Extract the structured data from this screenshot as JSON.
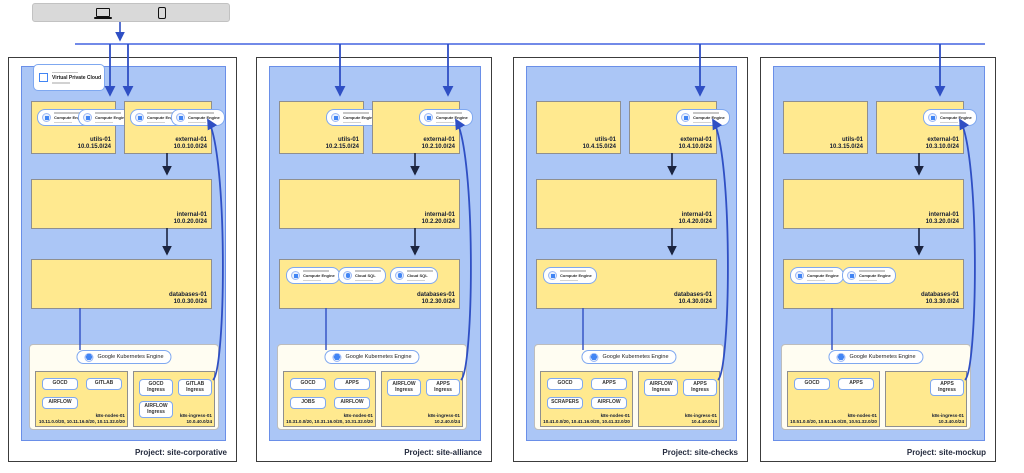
{
  "device_bar": {
    "icons": [
      "laptop",
      "smartphone"
    ]
  },
  "shared": {
    "vpc_label": "Virtual Private Cloud",
    "gke_label": "Google Kubernetes Engine",
    "compute_engine_label": "Compute Engine",
    "cloud_sql_label": "Cloud SQL"
  },
  "colors": {
    "vpc_fill": "#abc6f6",
    "subnet_fill": "#ffe98f",
    "arrow_blue": "#3d5ed2",
    "arrow_dark": "#1b2440"
  },
  "projects": [
    {
      "label": "Project: site-corporative",
      "subnets": {
        "utils": {
          "name": "utils-01",
          "cidr": "10.0.15.0/24",
          "chips": [
            "Compute Engine",
            "Compute Engine"
          ]
        },
        "external": {
          "name": "external-01",
          "cidr": "10.0.10.0/24",
          "chips": [
            "Compute Engine",
            "Compute Engine"
          ]
        },
        "internal": {
          "name": "internal-01",
          "cidr": "10.0.20.0/24",
          "chips": []
        },
        "databases": {
          "name": "databases-01",
          "cidr": "10.0.30.0/24",
          "chips": []
        }
      },
      "gke": {
        "nodes": {
          "name": "k8s-nodes-01",
          "cidr": "10.11.0.0/20, 10.11.16.0/20, 10.11.32.0/20",
          "workloads": [
            "GOCD",
            "GITLAB",
            "AIRFLOW"
          ]
        },
        "ingress": {
          "name": "k8s-ingress-01",
          "cidr": "10.0.40.0/24",
          "workloads": [
            "GOCD Ingress",
            "GITLAB Ingress",
            "AIRFLOW Ingress"
          ]
        }
      }
    },
    {
      "label": "Project: site-alliance",
      "subnets": {
        "utils": {
          "name": "utils-01",
          "cidr": "10.2.15.0/24",
          "chips": [
            "Compute Engine"
          ]
        },
        "external": {
          "name": "external-01",
          "cidr": "10.2.10.0/24",
          "chips": [
            "Compute Engine"
          ]
        },
        "internal": {
          "name": "internal-01",
          "cidr": "10.2.20.0/24",
          "chips": []
        },
        "databases": {
          "name": "databases-01",
          "cidr": "10.2.30.0/24",
          "chips": [
            "Compute Engine",
            "Cloud SQL",
            "Cloud SQL"
          ]
        }
      },
      "gke": {
        "nodes": {
          "name": "k8s-nodes-01",
          "cidr": "10.31.0.0/20, 10.31.16.0/20, 10.31.32.0/20",
          "workloads": [
            "GOCD",
            "APPS",
            "JOBS",
            "AIRFLOW"
          ]
        },
        "ingress": {
          "name": "k8s-ingress-01",
          "cidr": "10.2.40.0/24",
          "workloads": [
            "AIRFLOW Ingress",
            "APPS Ingress"
          ]
        }
      }
    },
    {
      "label": "Project: site-checks",
      "subnets": {
        "utils": {
          "name": "utils-01",
          "cidr": "10.4.15.0/24",
          "chips": []
        },
        "external": {
          "name": "external-01",
          "cidr": "10.4.10.0/24",
          "chips": [
            "Compute Engine"
          ]
        },
        "internal": {
          "name": "internal-01",
          "cidr": "10.4.20.0/24",
          "chips": []
        },
        "databases": {
          "name": "databases-01",
          "cidr": "10.4.30.0/24",
          "chips": [
            "Compute Engine"
          ]
        }
      },
      "gke": {
        "nodes": {
          "name": "k8s-nodes-01",
          "cidr": "10.41.0.0/20, 10.41.16.0/20, 10.41.32.0/20",
          "workloads": [
            "GOCD",
            "APPS",
            "SCRAPERS",
            "AIRFLOW"
          ]
        },
        "ingress": {
          "name": "k8s-ingress-01",
          "cidr": "10.4.40.0/24",
          "workloads": [
            "AIRFLOW Ingress",
            "APPS Ingress"
          ]
        }
      }
    },
    {
      "label": "Project: site-mockup",
      "subnets": {
        "utils": {
          "name": "utils-01",
          "cidr": "10.3.15.0/24",
          "chips": []
        },
        "external": {
          "name": "external-01",
          "cidr": "10.3.10.0/24",
          "chips": [
            "Compute Engine"
          ]
        },
        "internal": {
          "name": "internal-01",
          "cidr": "10.3.20.0/24",
          "chips": []
        },
        "databases": {
          "name": "databases-01",
          "cidr": "10.3.30.0/24",
          "chips": [
            "Compute Engine",
            "Compute Engine"
          ]
        }
      },
      "gke": {
        "nodes": {
          "name": "k8s-nodes-01",
          "cidr": "10.51.0.0/20, 10.51.16.0/20, 10.51.32.0/20",
          "workloads": [
            "GOCD",
            "APPS"
          ]
        },
        "ingress": {
          "name": "k8s-ingress-01",
          "cidr": "10.3.40.0/24",
          "workloads": [
            "APPS Ingress"
          ]
        }
      }
    }
  ]
}
